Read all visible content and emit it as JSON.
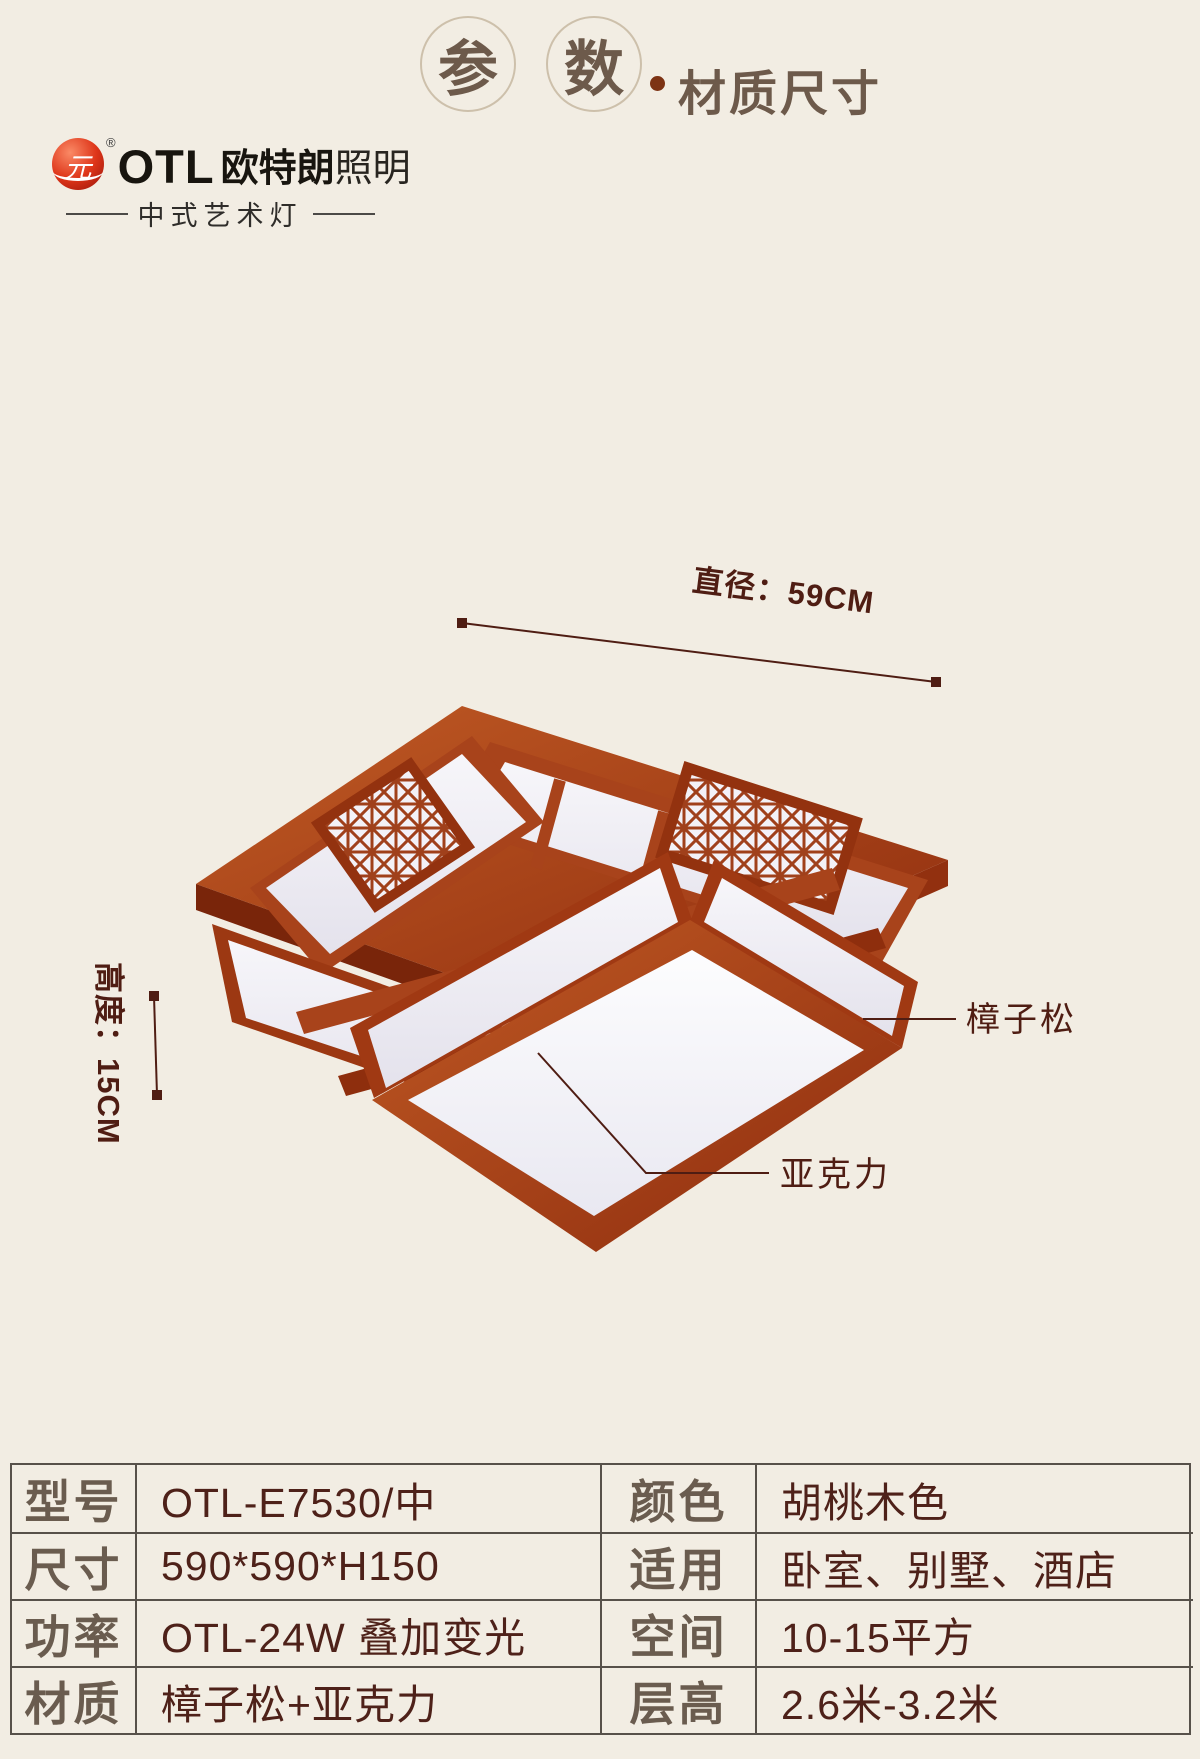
{
  "header": {
    "circled_chars": [
      "参",
      "数"
    ],
    "dot": "·",
    "subtitle": "材质尺寸"
  },
  "logo": {
    "symbol_glyph": "元",
    "registered_mark": "®",
    "brand_latin": "OTL",
    "brand_cn_bold": "欧特朗",
    "brand_cn_light": "照明",
    "tagline": "中式艺术灯"
  },
  "figure": {
    "diameter_label": "直径：59CM",
    "height_label": "高度：15CM",
    "callout_wood": "樟子松",
    "callout_acrylic": "亚克力"
  },
  "spec_table": {
    "left_rows": [
      {
        "label": "型号",
        "value": "OTL-E7530/中"
      },
      {
        "label": "尺寸",
        "value": "590*590*H150"
      },
      {
        "label": "功率",
        "value": "OTL-24W 叠加变光"
      },
      {
        "label": "材质",
        "value": "樟子松+亚克力"
      }
    ],
    "right_rows": [
      {
        "label": "颜色",
        "value": "胡桃木色"
      },
      {
        "label": "适用",
        "value": "卧室、别墅、酒店"
      },
      {
        "label": "空间",
        "value": "10-15平方"
      },
      {
        "label": "层高",
        "value": "2.6米-3.2米"
      }
    ]
  },
  "colors": {
    "background": "#f2ede3",
    "wood_light": "#c05a24",
    "wood_dark": "#8e2c0e",
    "acrylic_panel": "#f5f4f8",
    "annotation_text": "#4f1d13",
    "heading_text": "#6d5a4b",
    "table_border": "#57514a",
    "table_label_text": "#6a5c4f",
    "table_value_text": "#4e2119",
    "logo_red": "#de3519"
  }
}
